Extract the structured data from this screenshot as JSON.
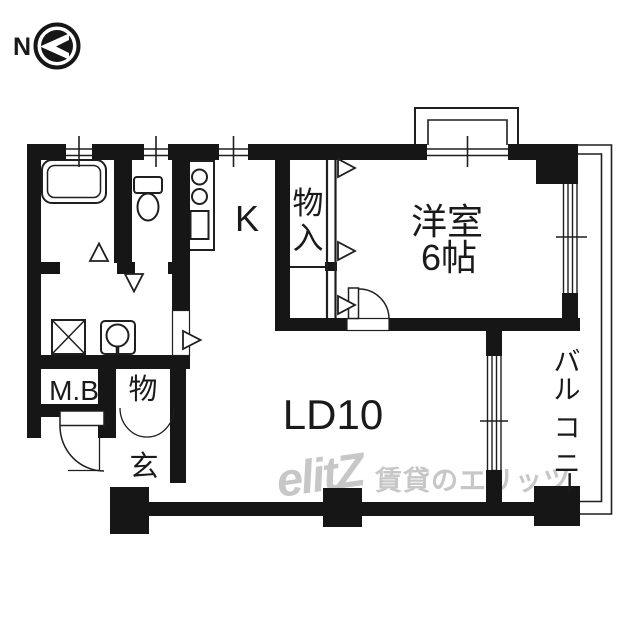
{
  "compass": {
    "north_label": "N"
  },
  "labels": {
    "kitchen": "K",
    "closet": "物入",
    "western_room_name": "洋室",
    "western_room_size": "6帖",
    "living_dining": "LD10",
    "meter_box": "M.B",
    "storage": "物",
    "entrance": "玄",
    "balcony": "バルコニー"
  },
  "watermark": {
    "logo": "elitZ",
    "company": "賃貸のエリッツ"
  },
  "colors": {
    "wall": "#161616",
    "line": "#1f1f1f",
    "text": "#1a1a1a",
    "watermark": "#c7c7c7",
    "background": "#ffffff"
  }
}
